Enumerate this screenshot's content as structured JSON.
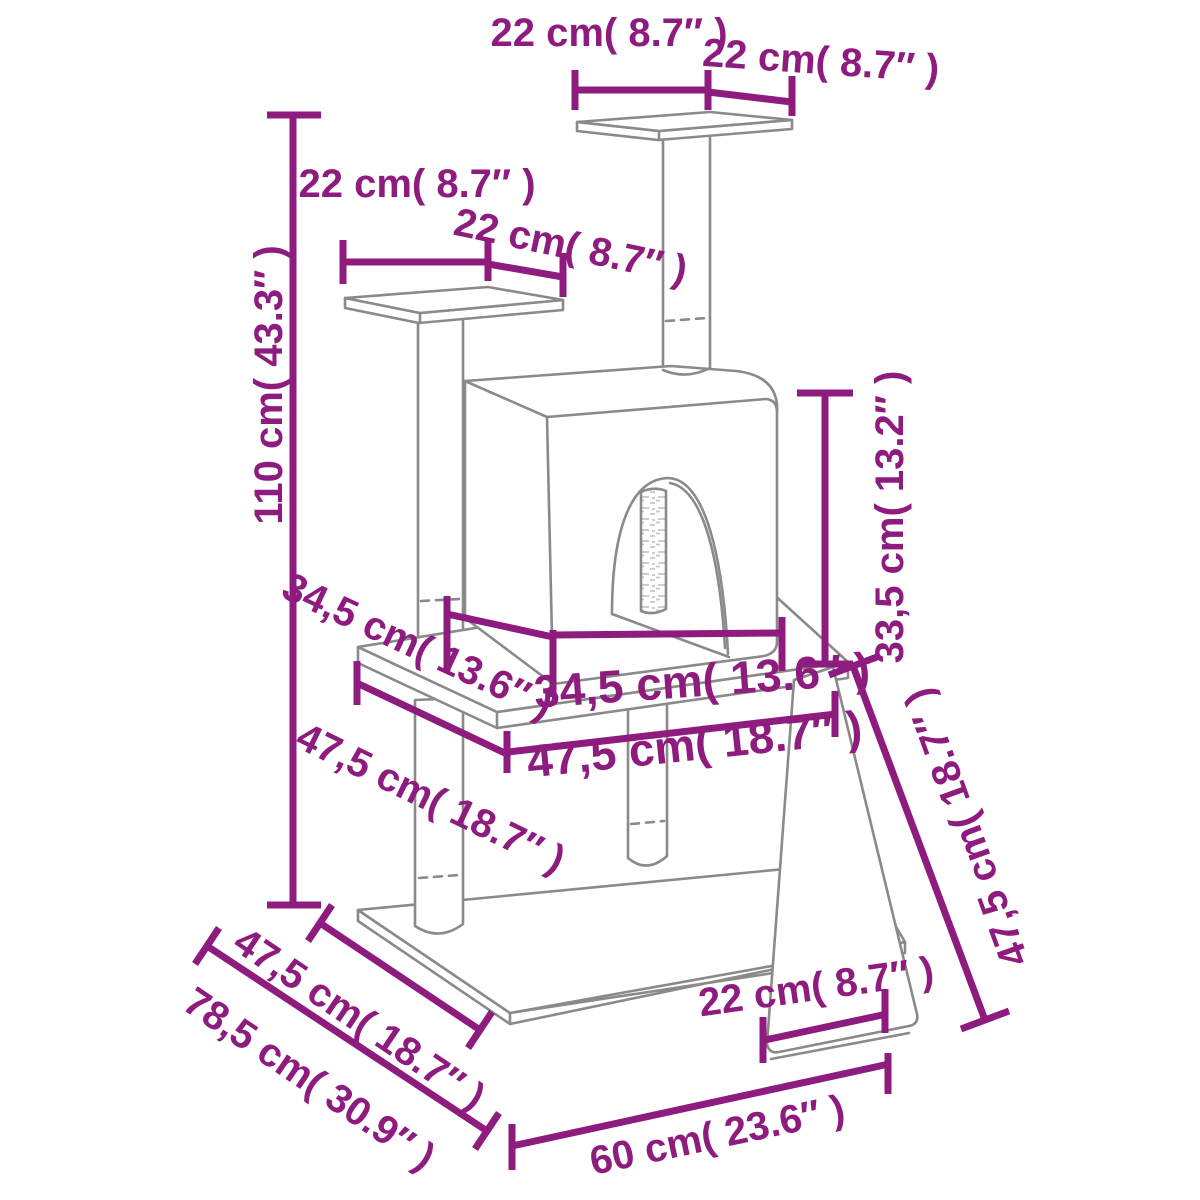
{
  "diagram": {
    "subject": "cat-tree-with-condo-ramp-dimension-diagram",
    "colors": {
      "dimension_lines": "#8E1B7E",
      "artwork_lines": "#8A8A8A",
      "background": "#FFFFFF"
    }
  },
  "labels": {
    "top_platform_width": "22 cm( 8.7″ )",
    "top_platform_depth": "22 cm( 8.7″ )",
    "side_platform_width": "22 cm( 8.7″ )",
    "side_platform_depth": "22 cm( 8.7″ )",
    "total_height": "110 cm( 43.3″ )",
    "condo_height": "33,5 cm( 13.2″ )",
    "condo_depth": "34,5 cm( 13.6″ )",
    "condo_width": "34,5 cm( 13.6″ )",
    "shelf_depth": "47,5 cm( 18.7″ )",
    "shelf_width": "47,5 cm( 18.7″ )",
    "ramp_length": "47,5 cm( 18.7″ )",
    "base_depth": "47,5 cm( 18.7″ )",
    "footprint_depth": "78,5 cm( 30.9″ )",
    "ramp_width": "22 cm( 8.7″ )",
    "base_width": "60 cm( 23.6″ )"
  }
}
